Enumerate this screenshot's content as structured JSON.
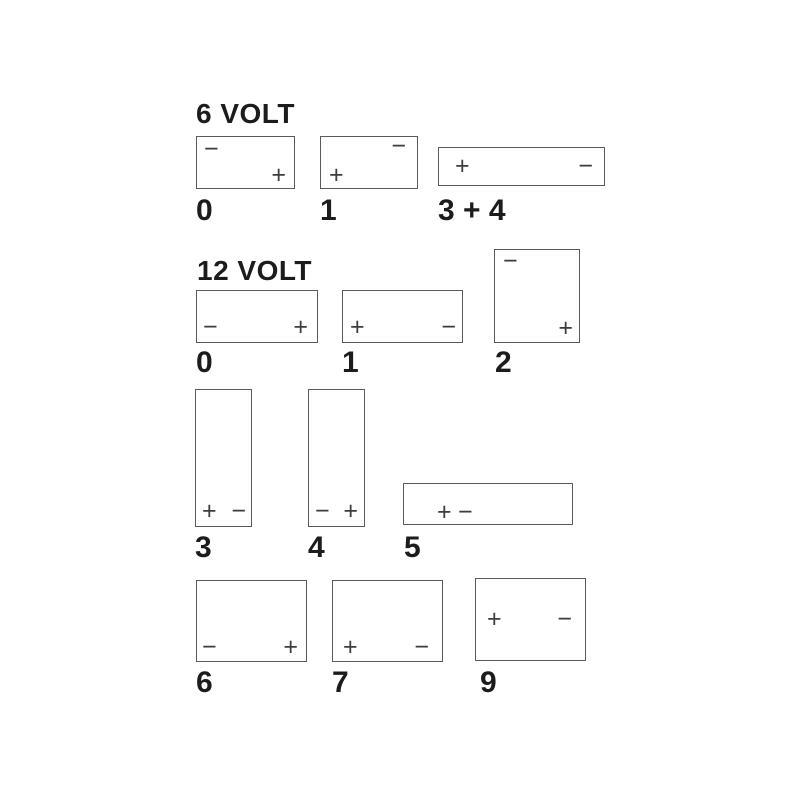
{
  "page": {
    "background": "#ffffff",
    "colors": {
      "line": "#5a5a5a",
      "heading_text": "#1c1c1c",
      "terminal_symbol": "#3d3d3d"
    }
  },
  "diagram": {
    "sections": [
      {
        "id": "six-volt",
        "title": "6 VOLT",
        "batteries": [
          {
            "label": "0",
            "terminals": [
              {
                "name": "negative",
                "glyph": "−",
                "position": "top-left"
              },
              {
                "name": "positive",
                "glyph": "+",
                "position": "bottom-right"
              }
            ]
          },
          {
            "label": "1",
            "terminals": [
              {
                "name": "negative",
                "glyph": "−",
                "position": "top-right"
              },
              {
                "name": "positive",
                "glyph": "+",
                "position": "bottom-left"
              }
            ]
          },
          {
            "label": "3 + 4",
            "terminals": [
              {
                "name": "positive",
                "glyph": "+",
                "position": "middle-left"
              },
              {
                "name": "negative",
                "glyph": "−",
                "position": "middle-right"
              }
            ]
          }
        ]
      },
      {
        "id": "twelve-volt",
        "title": "12 VOLT",
        "batteries": [
          {
            "label": "0",
            "terminals": [
              {
                "name": "negative",
                "glyph": "−",
                "position": "bottom-left"
              },
              {
                "name": "positive",
                "glyph": "+",
                "position": "bottom-right"
              }
            ]
          },
          {
            "label": "1",
            "terminals": [
              {
                "name": "positive",
                "glyph": "+",
                "position": "bottom-left"
              },
              {
                "name": "negative",
                "glyph": "−",
                "position": "bottom-right"
              }
            ]
          },
          {
            "label": "2",
            "terminals": [
              {
                "name": "negative",
                "glyph": "−",
                "position": "top-left"
              },
              {
                "name": "positive",
                "glyph": "+",
                "position": "bottom-right"
              }
            ]
          },
          {
            "label": "3",
            "terminals": [
              {
                "name": "positive",
                "glyph": "+",
                "position": "bottom-left"
              },
              {
                "name": "negative",
                "glyph": "−",
                "position": "bottom-right"
              }
            ]
          },
          {
            "label": "4",
            "terminals": [
              {
                "name": "negative",
                "glyph": "−",
                "position": "bottom-left"
              },
              {
                "name": "positive",
                "glyph": "+",
                "position": "bottom-right"
              }
            ]
          },
          {
            "label": "5",
            "terminals": [
              {
                "name": "positive",
                "glyph": "+",
                "position": "middle-left-pair"
              },
              {
                "name": "negative",
                "glyph": "−",
                "position": "middle-left-pair"
              }
            ]
          },
          {
            "label": "6",
            "terminals": [
              {
                "name": "negative",
                "glyph": "−",
                "position": "bottom-left"
              },
              {
                "name": "positive",
                "glyph": "+",
                "position": "bottom-right"
              }
            ]
          },
          {
            "label": "7",
            "terminals": [
              {
                "name": "positive",
                "glyph": "+",
                "position": "bottom-left"
              },
              {
                "name": "negative",
                "glyph": "−",
                "position": "bottom-right"
              }
            ]
          },
          {
            "label": "9",
            "terminals": [
              {
                "name": "positive",
                "glyph": "+",
                "position": "middle-left"
              },
              {
                "name": "negative",
                "glyph": "−",
                "position": "middle-right"
              }
            ]
          }
        ]
      }
    ]
  }
}
